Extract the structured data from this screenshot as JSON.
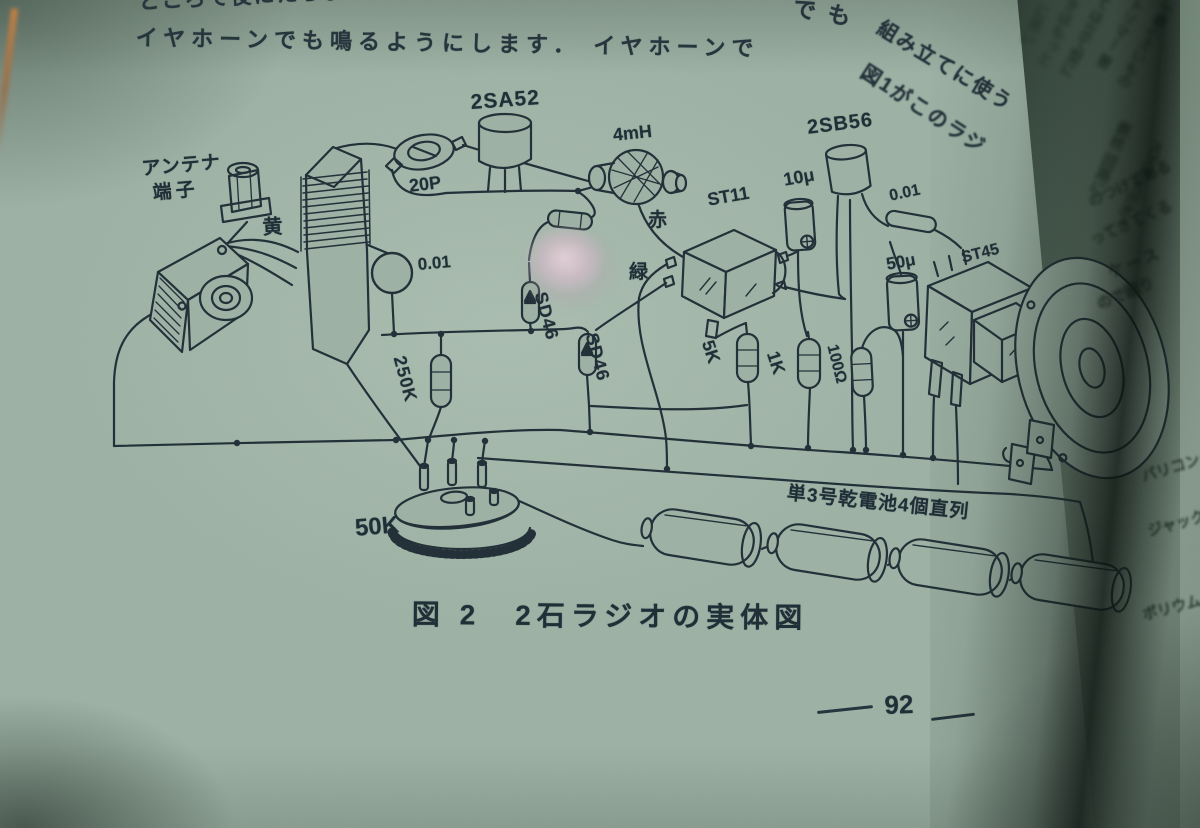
{
  "left_page": {
    "body_text_top": {
      "line1": "ところで役にたちょう",
      "line1_end_fragment": "でも",
      "line2": "イヤホーンでも鳴るようにします． イヤホーンで"
    },
    "heading_fragments": {
      "assembly": "組み立てに使う",
      "figure1": "図1がこのラジ"
    },
    "component_labels": {
      "antenna_terminal_line1": "アンテナ",
      "antenna_terminal_line2": "端子",
      "wire_yellow": "黄",
      "trimmer_capacitor": "20P",
      "transistor_1": "2SA52",
      "capacitor_disc": "0.01",
      "choke_coil": "4mH",
      "wire_red": "赤",
      "wire_green": "緑",
      "diode_1": "SD46",
      "diode_2": "SD46",
      "transformer_input": "ST11",
      "capacitor_10u": "10μ",
      "transistor_2": "2SB56",
      "capacitor_tube": "0.01",
      "capacitor_50u": "50μ",
      "transformer_output": "ST45",
      "resistor_250k": "250K",
      "resistor_5k": "5K",
      "resistor_1k": "1K",
      "resistor_100ohm": "100Ω",
      "potentiometer": "50K",
      "battery_note": "単3号乾電池4個直列"
    },
    "figure_caption": "図 2　2石ラジオの実体図",
    "page_number": "92"
  },
  "right_page": {
    "fragments": [
      "に思い",
      "きはもっと",
      "ては立て型に",
      "トリマー 普",
      "一番小さいもの",
      "鉄枕 回路に",
      "スズがちがぎ",
      "のつけてある",
      "ってきてくる",
      "ケース",
      "ので困り",
      "バリコン",
      "ジャック",
      "ボリウム"
    ]
  },
  "colors": {
    "paper": "#9db1a4",
    "ink": "#1f2c35"
  }
}
